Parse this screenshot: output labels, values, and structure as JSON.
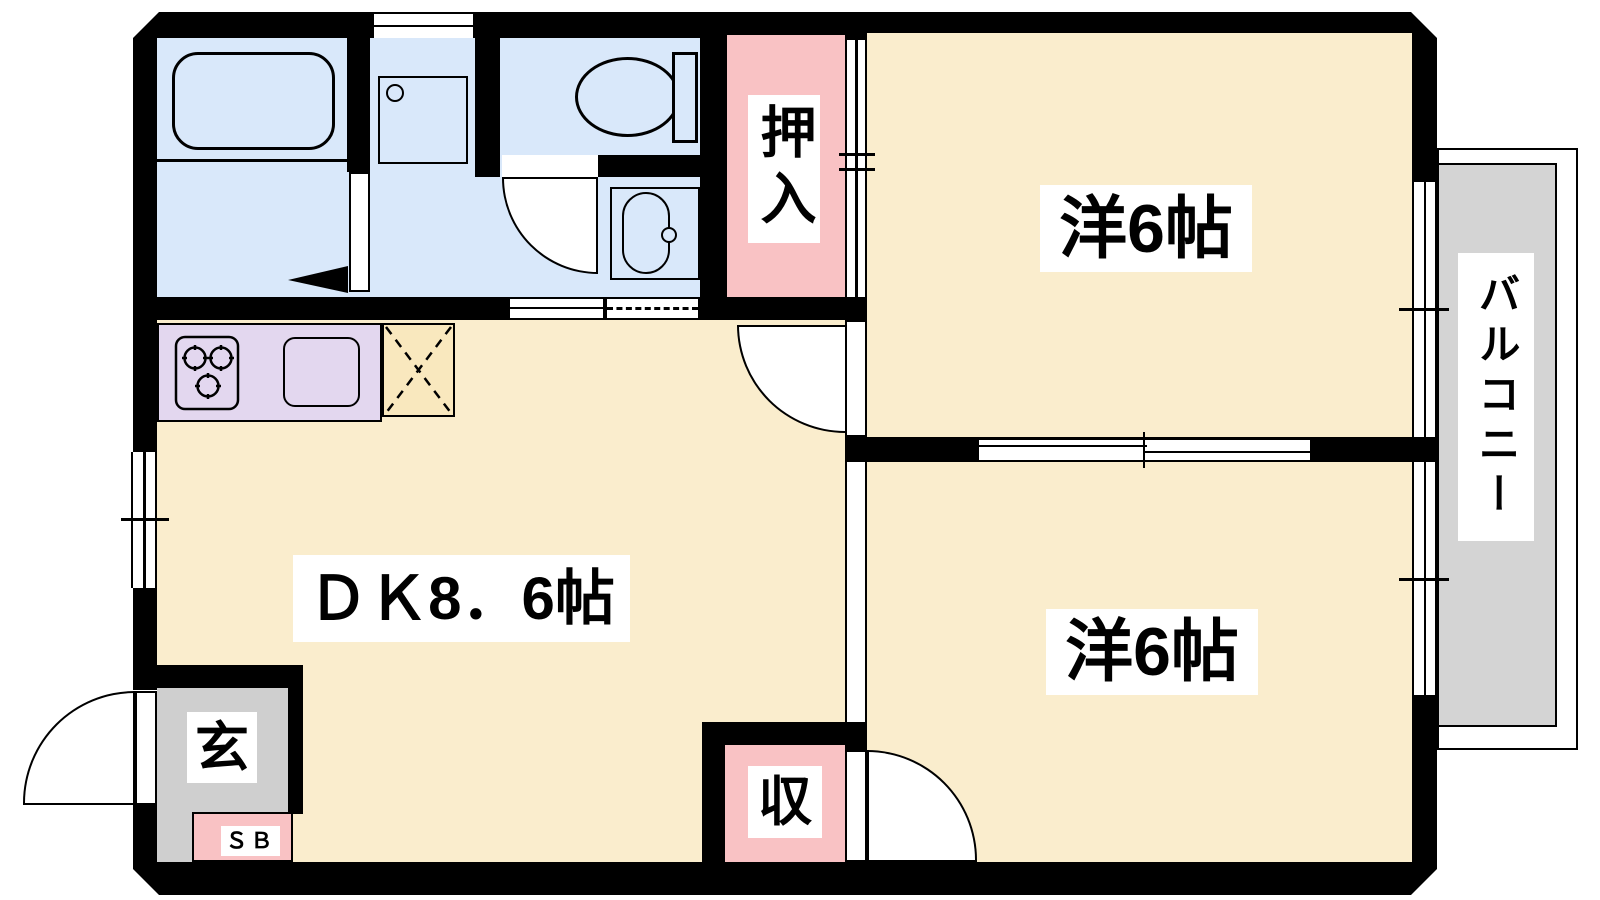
{
  "plan": {
    "type": "apartment-floor-plan",
    "labels": {
      "closet": "押入",
      "room_top": "洋6帖",
      "room_bottom": "洋6帖",
      "dk": "ＤＫ8．6帖",
      "balcony": "バルコニー",
      "storage": "収",
      "entrance": "玄",
      "shoe_box": "ＳＢ"
    },
    "colors": {
      "wall": "#000000",
      "room_floor": "#FAEDCD",
      "wet_area_floor": "#D9E8FA",
      "closet_fill": "#F9C2C4",
      "kitchen_counter": "#E3D7EF",
      "fridge_space": "#F9E8BE",
      "entrance_floor": "#CFCFCF",
      "balcony_floor": "#D4D4D4"
    }
  }
}
